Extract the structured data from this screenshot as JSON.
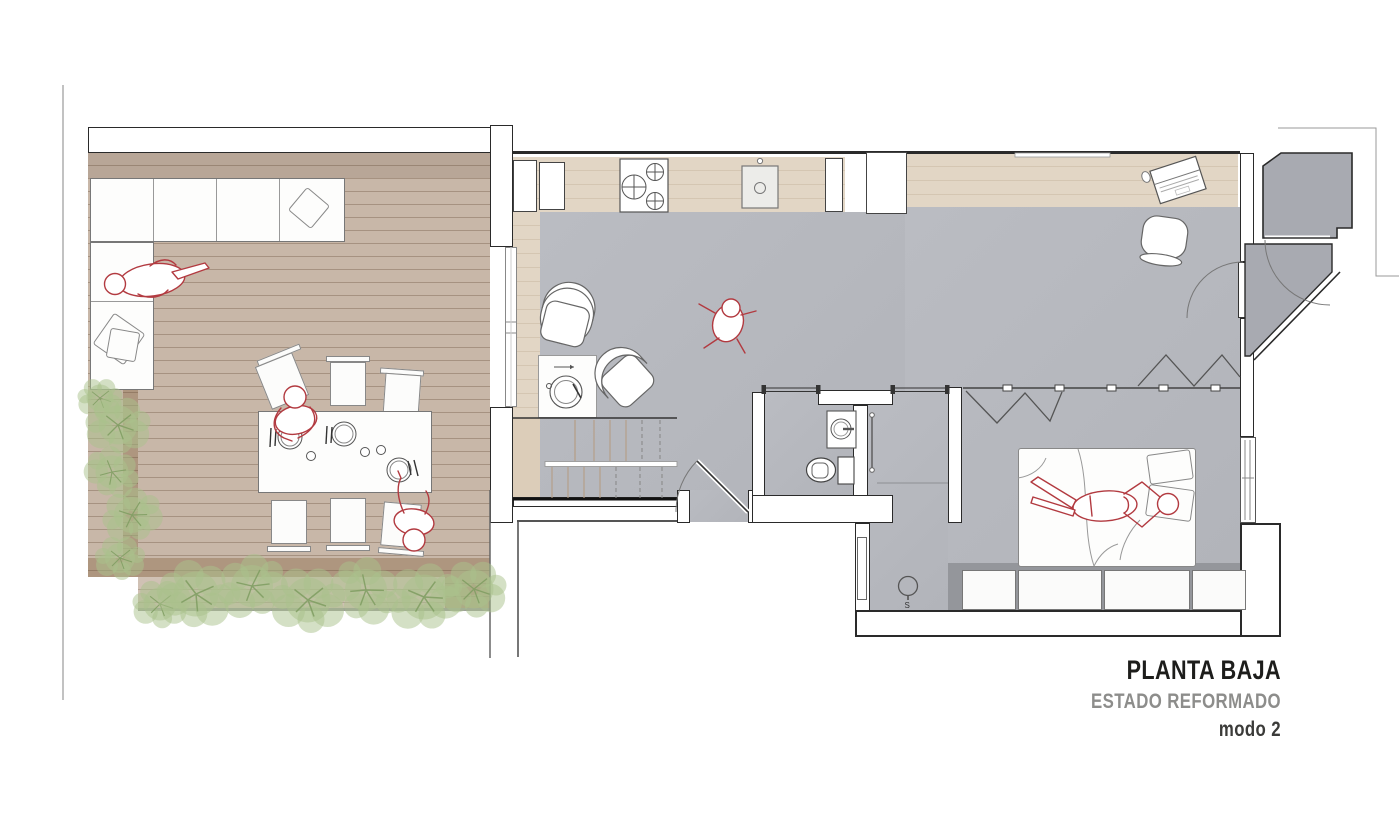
{
  "title_block": {
    "line1": "PLANTA BAJA",
    "line2": "ESTADO REFORMADO",
    "line3": "modo 2"
  },
  "annotations": {
    "shower_drain_label": "S"
  },
  "palette": {
    "wood_deck": "#c8b7a8",
    "wood_deck_dark": "#ae967f",
    "wood_interior": "#e2d6c5",
    "wood_stairs": "#dccdb9",
    "floor_gray": "#b2b4ba",
    "floor_gray_dark": "#a8aab1",
    "wall_line": "#2a2a2a",
    "furniture_line": "#777777",
    "figure_red": "#b23a40",
    "plant_green": "#a9c28c",
    "plant_stem": "#7e9c60",
    "title_black": "#1d1d1b",
    "title_gray": "#8d8d8b",
    "title_mode": "#3b3b39"
  }
}
